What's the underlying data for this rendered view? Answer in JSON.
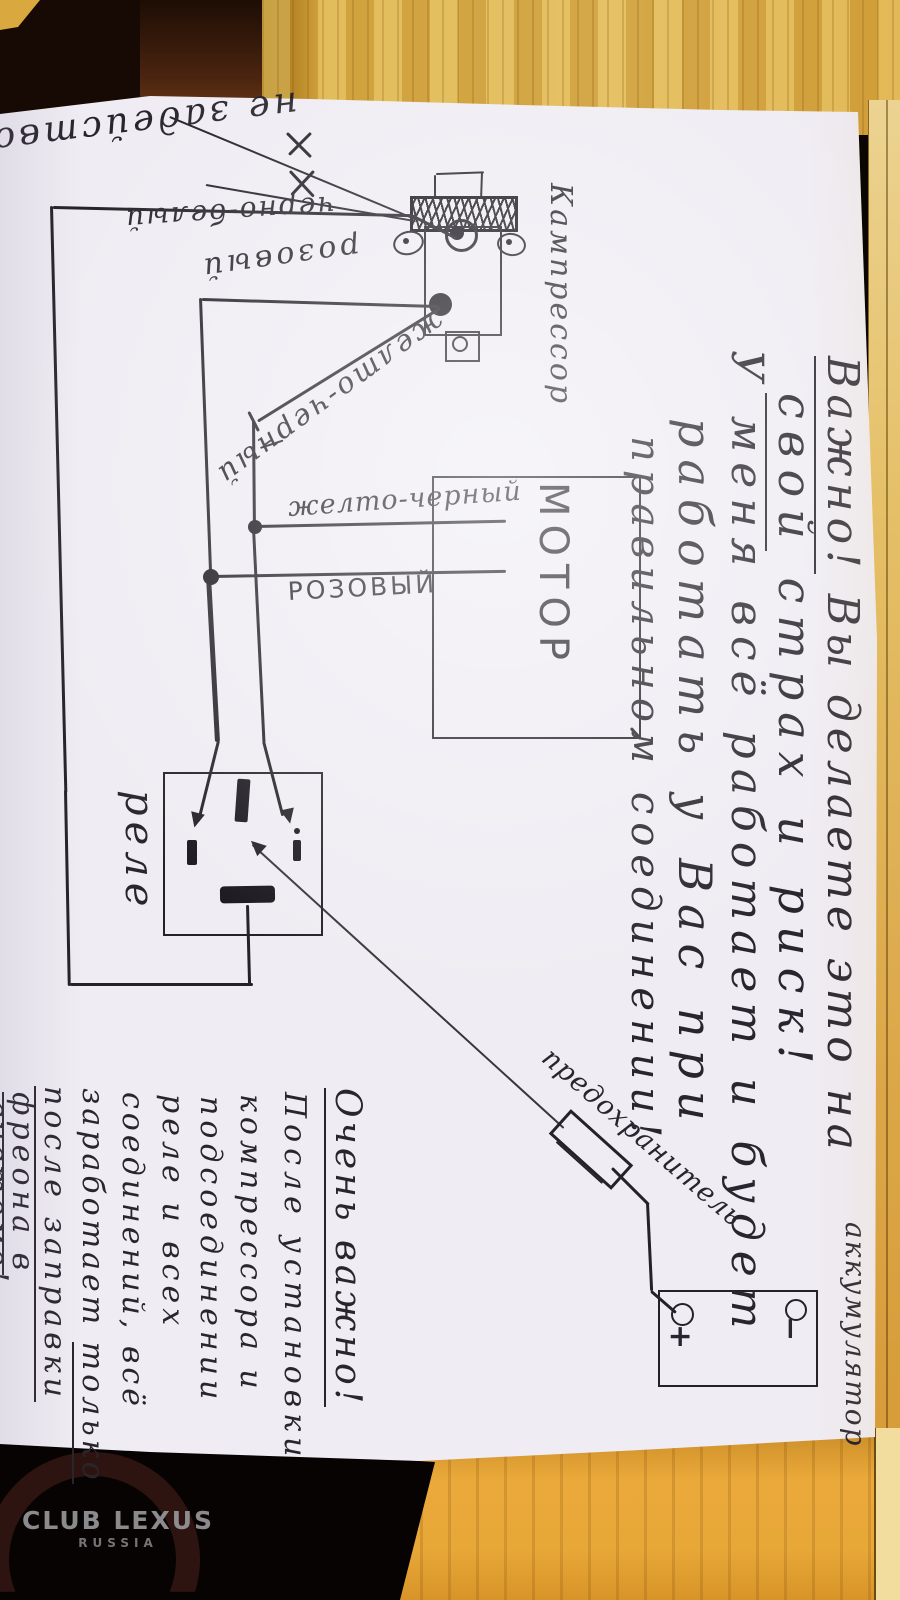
{
  "colors": {
    "ink": "#24212a",
    "paper": "#efecf3",
    "wood_top": "#d9ad44",
    "wood_plank": "#e6a132",
    "dark_background": "#0c0603"
  },
  "diagram": {
    "compressor_label": "Кампрессор",
    "not_used_label": "не задействована",
    "wire_black_white": "черно-белый",
    "wire_pink_cursive": "розовый",
    "wire_yellow_black_diagonal": "желто-черный",
    "wire_yellow_black_print": "желто-черный",
    "wire_pink_print": "РОЗОВЫЙ",
    "motor_label": "МОТОР",
    "relay_label": "реле",
    "fuse_label": "предохранитель",
    "battery_label": "аккумулятор",
    "battery_plus": "+",
    "battery_minus": "−"
  },
  "warning_note": {
    "line1_underlined": "Важно!",
    "line1_rest": " Вы делаете это на",
    "line2_underlined": "свой",
    "line2_rest": " страх и риск!",
    "line3": "У меня всё работает и будет",
    "line4": "работать у Вас при",
    "line5": "правильном соединении!"
  },
  "important_note": {
    "title": "Очень важно!",
    "line1": "После установки",
    "line2": "компрессора и",
    "line3": "подсоединении",
    "line4": "реле и всех",
    "line5": "соединений, всё",
    "line6_pre": "заработает ",
    "line6_underlined": "только",
    "line7": "после заправки",
    "line8": "фреона в",
    "line9": "системе!"
  },
  "watermark": {
    "line1": "CLUB LEXUS",
    "line2": "RUSSIA"
  }
}
